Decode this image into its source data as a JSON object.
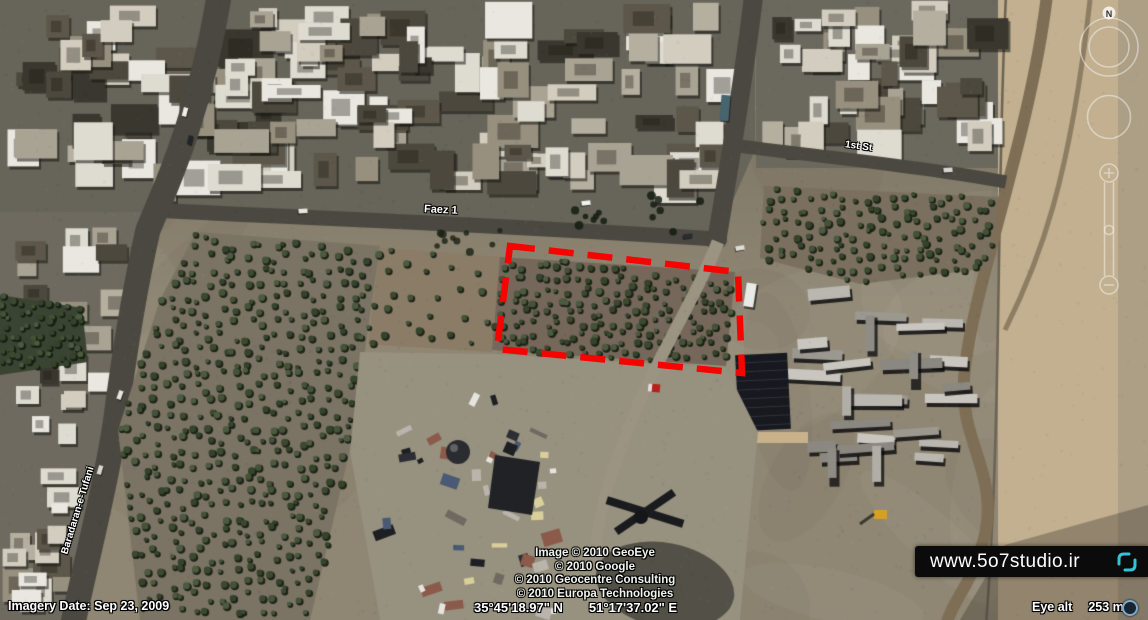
{
  "app": {
    "name": "google-earth-satellite-view"
  },
  "map": {
    "street_labels": [
      {
        "id": "faez",
        "text": "Faez 1"
      },
      {
        "id": "first-st",
        "text": "1st St"
      },
      {
        "id": "baradaran",
        "text": "Baradaran-e-Tufani"
      }
    ]
  },
  "navigation": {
    "north_label": "N"
  },
  "annotation": {
    "box_color": "#f50400"
  },
  "copyright": {
    "lines": [
      "Image © 2010 GeoEye",
      "© 2010 Google",
      "© 2010 Geocentre Consulting",
      "© 2010 Europa Technologies"
    ]
  },
  "watermark": {
    "url_text": "www.5o7studio.ir",
    "logo_color": "#35c2d6"
  },
  "status_bar": {
    "imagery_date": "Imagery Date: Sep 23, 2009",
    "latitude": "35°45'18.97\" N",
    "longitude": "51°17'37.02\" E",
    "eye_alt_label": "Eye alt",
    "eye_alt_value": "253 m"
  }
}
